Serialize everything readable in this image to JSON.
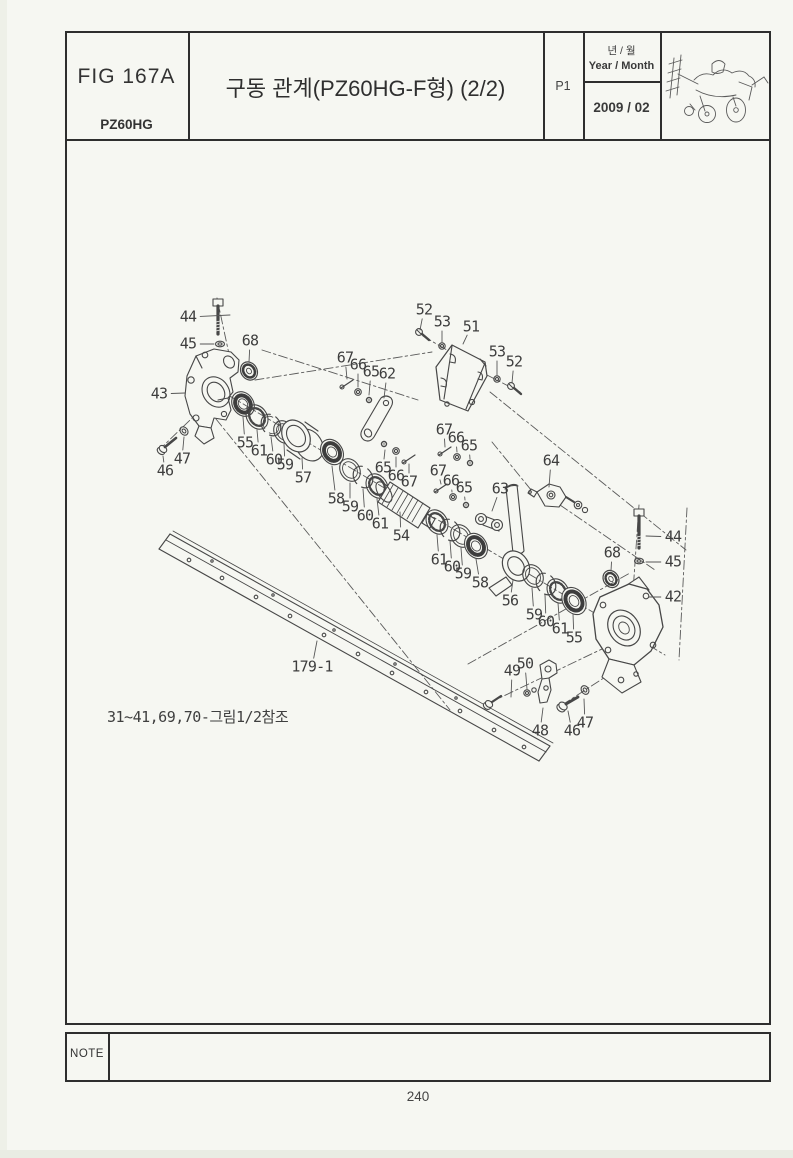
{
  "header": {
    "figure_id": "FIG 167A",
    "model": "PZ60HG",
    "title": "구동 관계(PZ60HG-F형) (2/2)",
    "page_code": "P1",
    "date_label_ko": "년 / 월",
    "date_label_en": "Year / Month",
    "date_value": "2009 / 02",
    "machine_icon": "rice-transplanter-line-drawing"
  },
  "diagram": {
    "reference_note": "31~41,69,70-그림1/2참조",
    "callouts": [
      {
        "label": "44",
        "x": 188,
        "y": 317,
        "lx": 230,
        "ly": 315
      },
      {
        "label": "45",
        "x": 188,
        "y": 344,
        "lx": 214,
        "ly": 344
      },
      {
        "label": "68",
        "x": 250,
        "y": 341,
        "lx": 249,
        "ly": 362
      },
      {
        "label": "43",
        "x": 159,
        "y": 394,
        "lx": 185,
        "ly": 393
      },
      {
        "label": "47",
        "x": 182,
        "y": 459,
        "lx": 184,
        "ly": 437
      },
      {
        "label": "46",
        "x": 165,
        "y": 471,
        "lx": 163,
        "ly": 456
      },
      {
        "label": "55",
        "x": 245,
        "y": 443,
        "lx": 243,
        "ly": 417
      },
      {
        "label": "61",
        "x": 259,
        "y": 451,
        "lx": 257,
        "ly": 430
      },
      {
        "label": "60",
        "x": 274,
        "y": 460,
        "lx": 271,
        "ly": 437
      },
      {
        "label": "59",
        "x": 285,
        "y": 465,
        "lx": 284,
        "ly": 444
      },
      {
        "label": "57",
        "x": 303,
        "y": 478,
        "lx": 302,
        "ly": 458
      },
      {
        "label": "58",
        "x": 336,
        "y": 499,
        "lx": 332,
        "ly": 466
      },
      {
        "label": "59",
        "x": 350,
        "y": 507,
        "lx": 350,
        "ly": 483
      },
      {
        "label": "60",
        "x": 365,
        "y": 516,
        "lx": 363,
        "ly": 489
      },
      {
        "label": "61",
        "x": 380,
        "y": 524,
        "lx": 377,
        "ly": 499
      },
      {
        "label": "54",
        "x": 401,
        "y": 536,
        "lx": 400,
        "ly": 512
      },
      {
        "label": "52",
        "x": 424,
        "y": 310,
        "lx": 420,
        "ly": 330
      },
      {
        "label": "53",
        "x": 442,
        "y": 322,
        "lx": 442,
        "ly": 342
      },
      {
        "label": "51",
        "x": 471,
        "y": 327,
        "lx": 463,
        "ly": 344
      },
      {
        "label": "53",
        "x": 497,
        "y": 352,
        "lx": 497,
        "ly": 375
      },
      {
        "label": "52",
        "x": 514,
        "y": 362,
        "lx": 512,
        "ly": 383
      },
      {
        "label": "67",
        "x": 345,
        "y": 358,
        "lx": 347,
        "ly": 379
      },
      {
        "label": "66",
        "x": 358,
        "y": 365,
        "lx": 358,
        "ly": 387
      },
      {
        "label": "65",
        "x": 371,
        "y": 372,
        "lx": 369,
        "ly": 395
      },
      {
        "label": "62",
        "x": 387,
        "y": 374,
        "lx": 384,
        "ly": 398
      },
      {
        "label": "67",
        "x": 444,
        "y": 430,
        "lx": 445,
        "ly": 447
      },
      {
        "label": "66",
        "x": 456,
        "y": 438,
        "lx": 457,
        "ly": 452
      },
      {
        "label": "65",
        "x": 469,
        "y": 446,
        "lx": 470,
        "ly": 459
      },
      {
        "label": "65",
        "x": 383,
        "y": 468,
        "lx": 385,
        "ly": 450
      },
      {
        "label": "66",
        "x": 396,
        "y": 476,
        "lx": 396,
        "ly": 457
      },
      {
        "label": "67",
        "x": 409,
        "y": 482,
        "lx": 409,
        "ly": 464
      },
      {
        "label": "67",
        "x": 438,
        "y": 471,
        "lx": 441,
        "ly": 484
      },
      {
        "label": "66",
        "x": 451,
        "y": 481,
        "lx": 452,
        "ly": 492
      },
      {
        "label": "65",
        "x": 464,
        "y": 488,
        "lx": 465,
        "ly": 500
      },
      {
        "label": "63",
        "x": 500,
        "y": 489,
        "lx": 492,
        "ly": 511
      },
      {
        "label": "64",
        "x": 551,
        "y": 461,
        "lx": 549,
        "ly": 487
      },
      {
        "label": "61",
        "x": 439,
        "y": 560,
        "lx": 437,
        "ly": 535
      },
      {
        "label": "60",
        "x": 452,
        "y": 567,
        "lx": 450,
        "ly": 541
      },
      {
        "label": "59",
        "x": 463,
        "y": 574,
        "lx": 461,
        "ly": 548
      },
      {
        "label": "58",
        "x": 480,
        "y": 583,
        "lx": 476,
        "ly": 559
      },
      {
        "label": "56",
        "x": 510,
        "y": 601,
        "lx": 513,
        "ly": 580
      },
      {
        "label": "59",
        "x": 534,
        "y": 615,
        "lx": 532,
        "ly": 588
      },
      {
        "label": "60",
        "x": 546,
        "y": 622,
        "lx": 545,
        "ly": 595
      },
      {
        "label": "61",
        "x": 560,
        "y": 629,
        "lx": 558,
        "ly": 603
      },
      {
        "label": "55",
        "x": 574,
        "y": 638,
        "lx": 573,
        "ly": 614
      },
      {
        "label": "68",
        "x": 612,
        "y": 553,
        "lx": 611,
        "ly": 571
      },
      {
        "label": "44",
        "x": 673,
        "y": 537,
        "lx": 646,
        "ly": 536
      },
      {
        "label": "45",
        "x": 673,
        "y": 562,
        "lx": 646,
        "ly": 562
      },
      {
        "label": "42",
        "x": 673,
        "y": 597,
        "lx": 649,
        "ly": 597
      },
      {
        "label": "50",
        "x": 525,
        "y": 664,
        "lx": 527,
        "ly": 689
      },
      {
        "label": "49",
        "x": 512,
        "y": 671,
        "lx": 511,
        "ly": 697
      },
      {
        "label": "48",
        "x": 540,
        "y": 731,
        "lx": 543,
        "ly": 708
      },
      {
        "label": "46",
        "x": 572,
        "y": 731,
        "lx": 568,
        "ly": 711
      },
      {
        "label": "47",
        "x": 585,
        "y": 723,
        "lx": 584,
        "ly": 699
      },
      {
        "label": "179-1",
        "x": 312,
        "y": 667,
        "lx": 317,
        "ly": 641
      }
    ]
  },
  "footer": {
    "note_label": "NOTE",
    "page_number": "240"
  },
  "colors": {
    "ink": "#3a3a3a",
    "border": "#2e2e2e",
    "paper": "#f6f7f2"
  }
}
